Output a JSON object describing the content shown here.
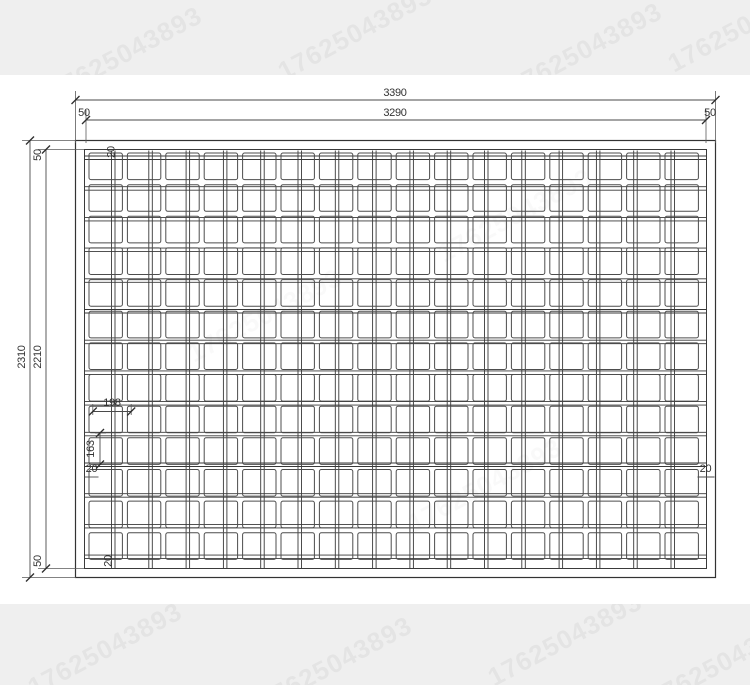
{
  "title": "welded-mesh-panel-dimension-drawing",
  "watermark": {
    "text": "17625043893"
  },
  "dimensions": {
    "overall_width": "3390",
    "inner_width": "3290",
    "edge_top_left": "50",
    "edge_top_right": "50",
    "overall_height": "2310",
    "inner_height": "2210",
    "edge_left_top": "50",
    "edge_left_bottom": "50",
    "cell_pitch_horizontal": "198",
    "cell_pitch_vertical": "163",
    "offset_left": "20",
    "offset_right": "20",
    "offset_top": "20",
    "offset_bottom": "20"
  },
  "mesh": {
    "columns": 16,
    "rows": 13,
    "grid": {
      "x0": 89,
      "y0": 153,
      "pitch_x": 38.4,
      "pitch_y": 31.65,
      "cell_w": 33.4,
      "cell_h": 26.6,
      "corner_radius": 2
    },
    "wires": {
      "vertical": {
        "start_x": 111.5,
        "pitch": 37.3,
        "count": 16,
        "gap": 3.5,
        "y1": 150.5,
        "y2": 568
      },
      "horizontal": {
        "start_y": 156.0,
        "pitch": 30.7,
        "count": 14,
        "gap": 3.5,
        "x1": 85,
        "x2": 706
      }
    },
    "colors": {
      "cell_stroke": "#4d4d4d",
      "wire_stroke": "#383838",
      "frame_stroke": "#333333",
      "dimension": "#333333",
      "band_background": "#efefef"
    }
  }
}
